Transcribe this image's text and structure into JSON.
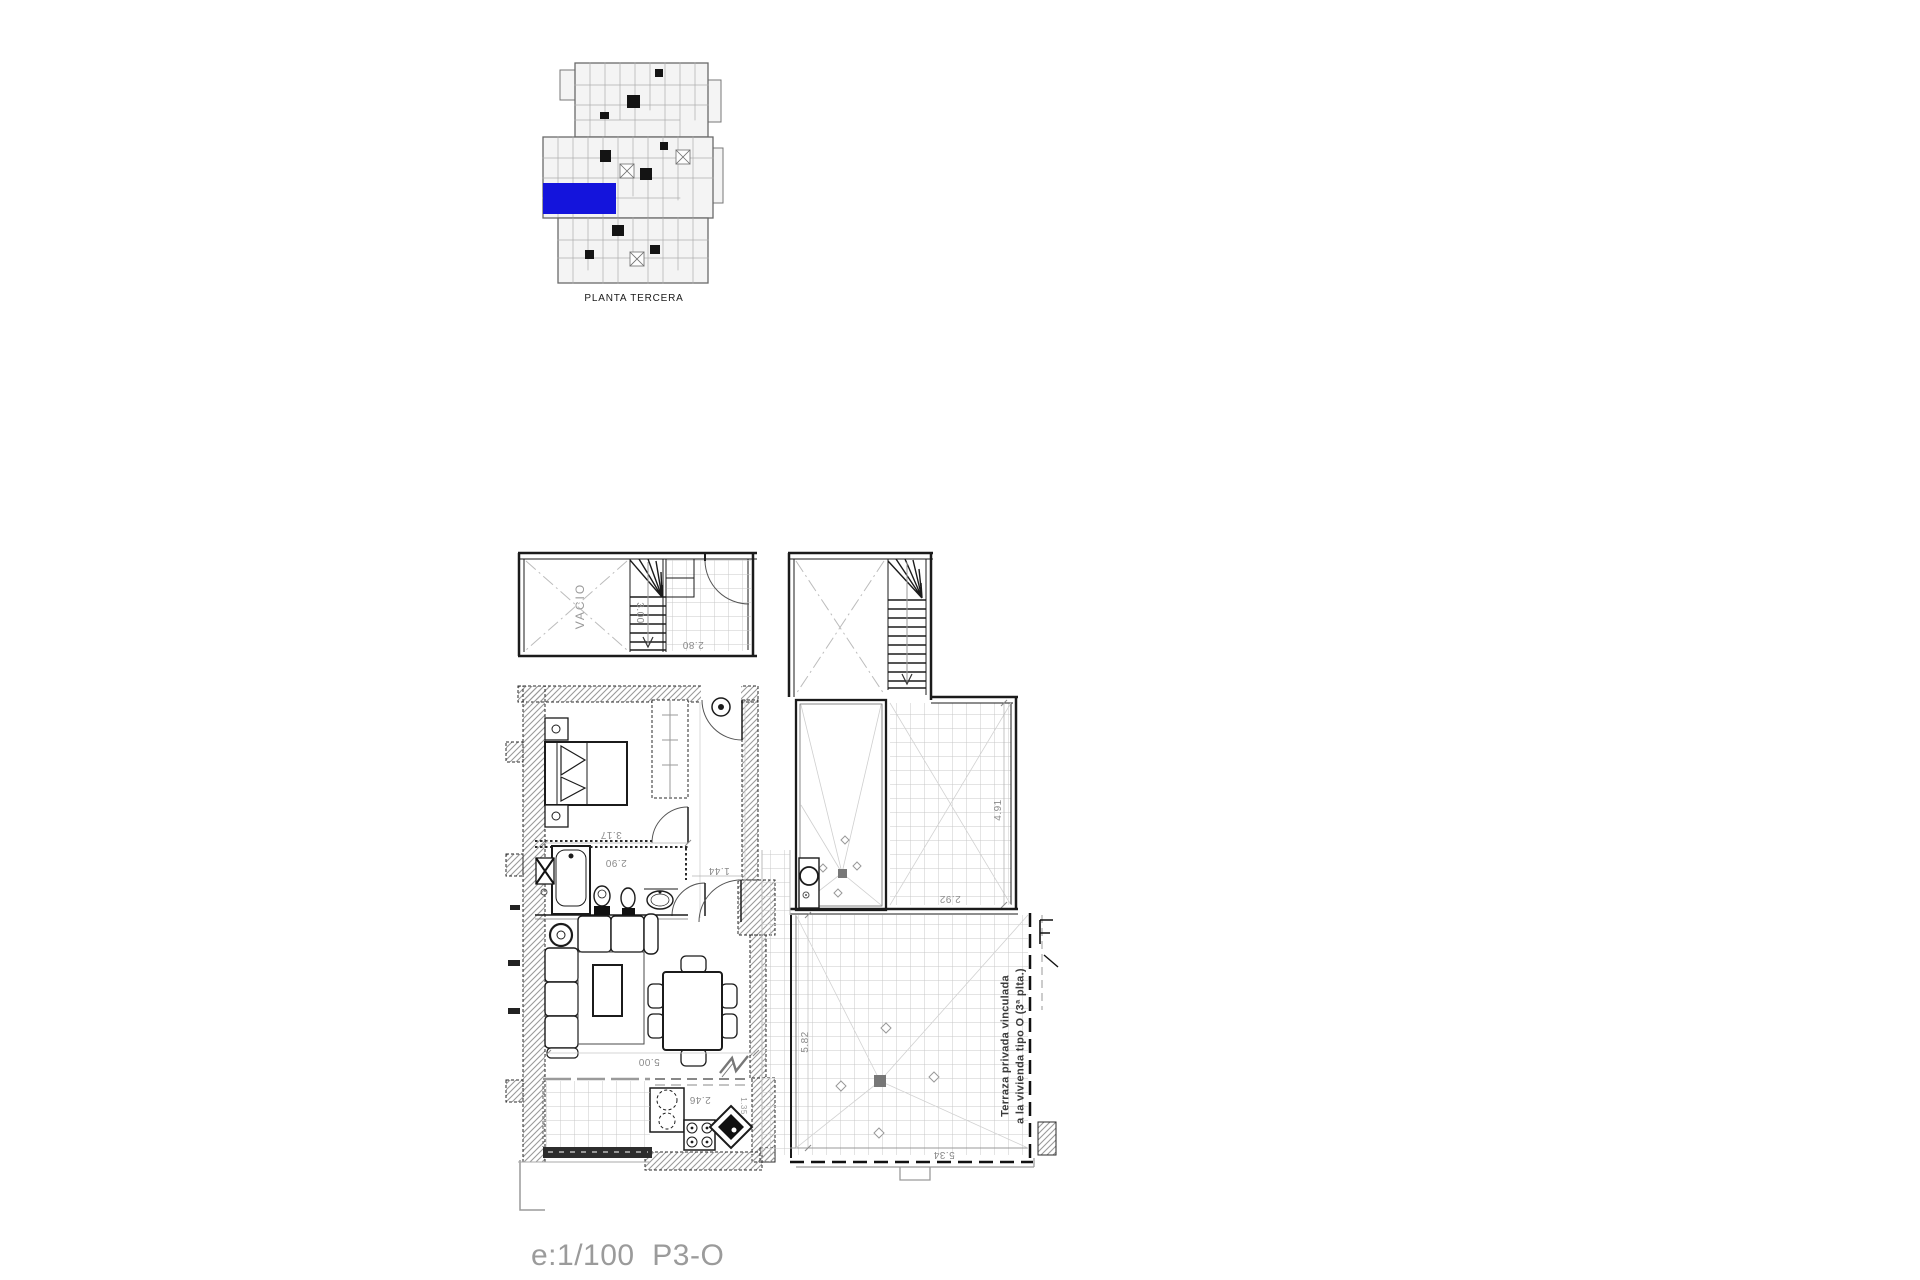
{
  "key_plan": {
    "label": "PLANTA TERCERA",
    "highlight_color": "#1414dc"
  },
  "floor_plan": {
    "labels": {
      "void": "VACIO",
      "terrace_line1": "Terraza privada vinculada",
      "terrace_line2": "a la vivienda tipo O (3ª plta.)"
    },
    "dimensions": {
      "stair_run": "3.00",
      "landing_width": "2.80",
      "bedroom_width": "3.17",
      "bathroom_width": "2.90",
      "hall_width": "1.44",
      "living_width": "5.00",
      "kitchen_width": "2.46",
      "kitchen_depth": "1.35",
      "terrace_upper_depth": "4.91",
      "terrace_upper_width": "2.92",
      "terrace_lower_depth": "5.82",
      "terrace_lower_width": "5.34"
    }
  },
  "footer": {
    "scale_and_unit": "e:1/100  P3-O"
  }
}
